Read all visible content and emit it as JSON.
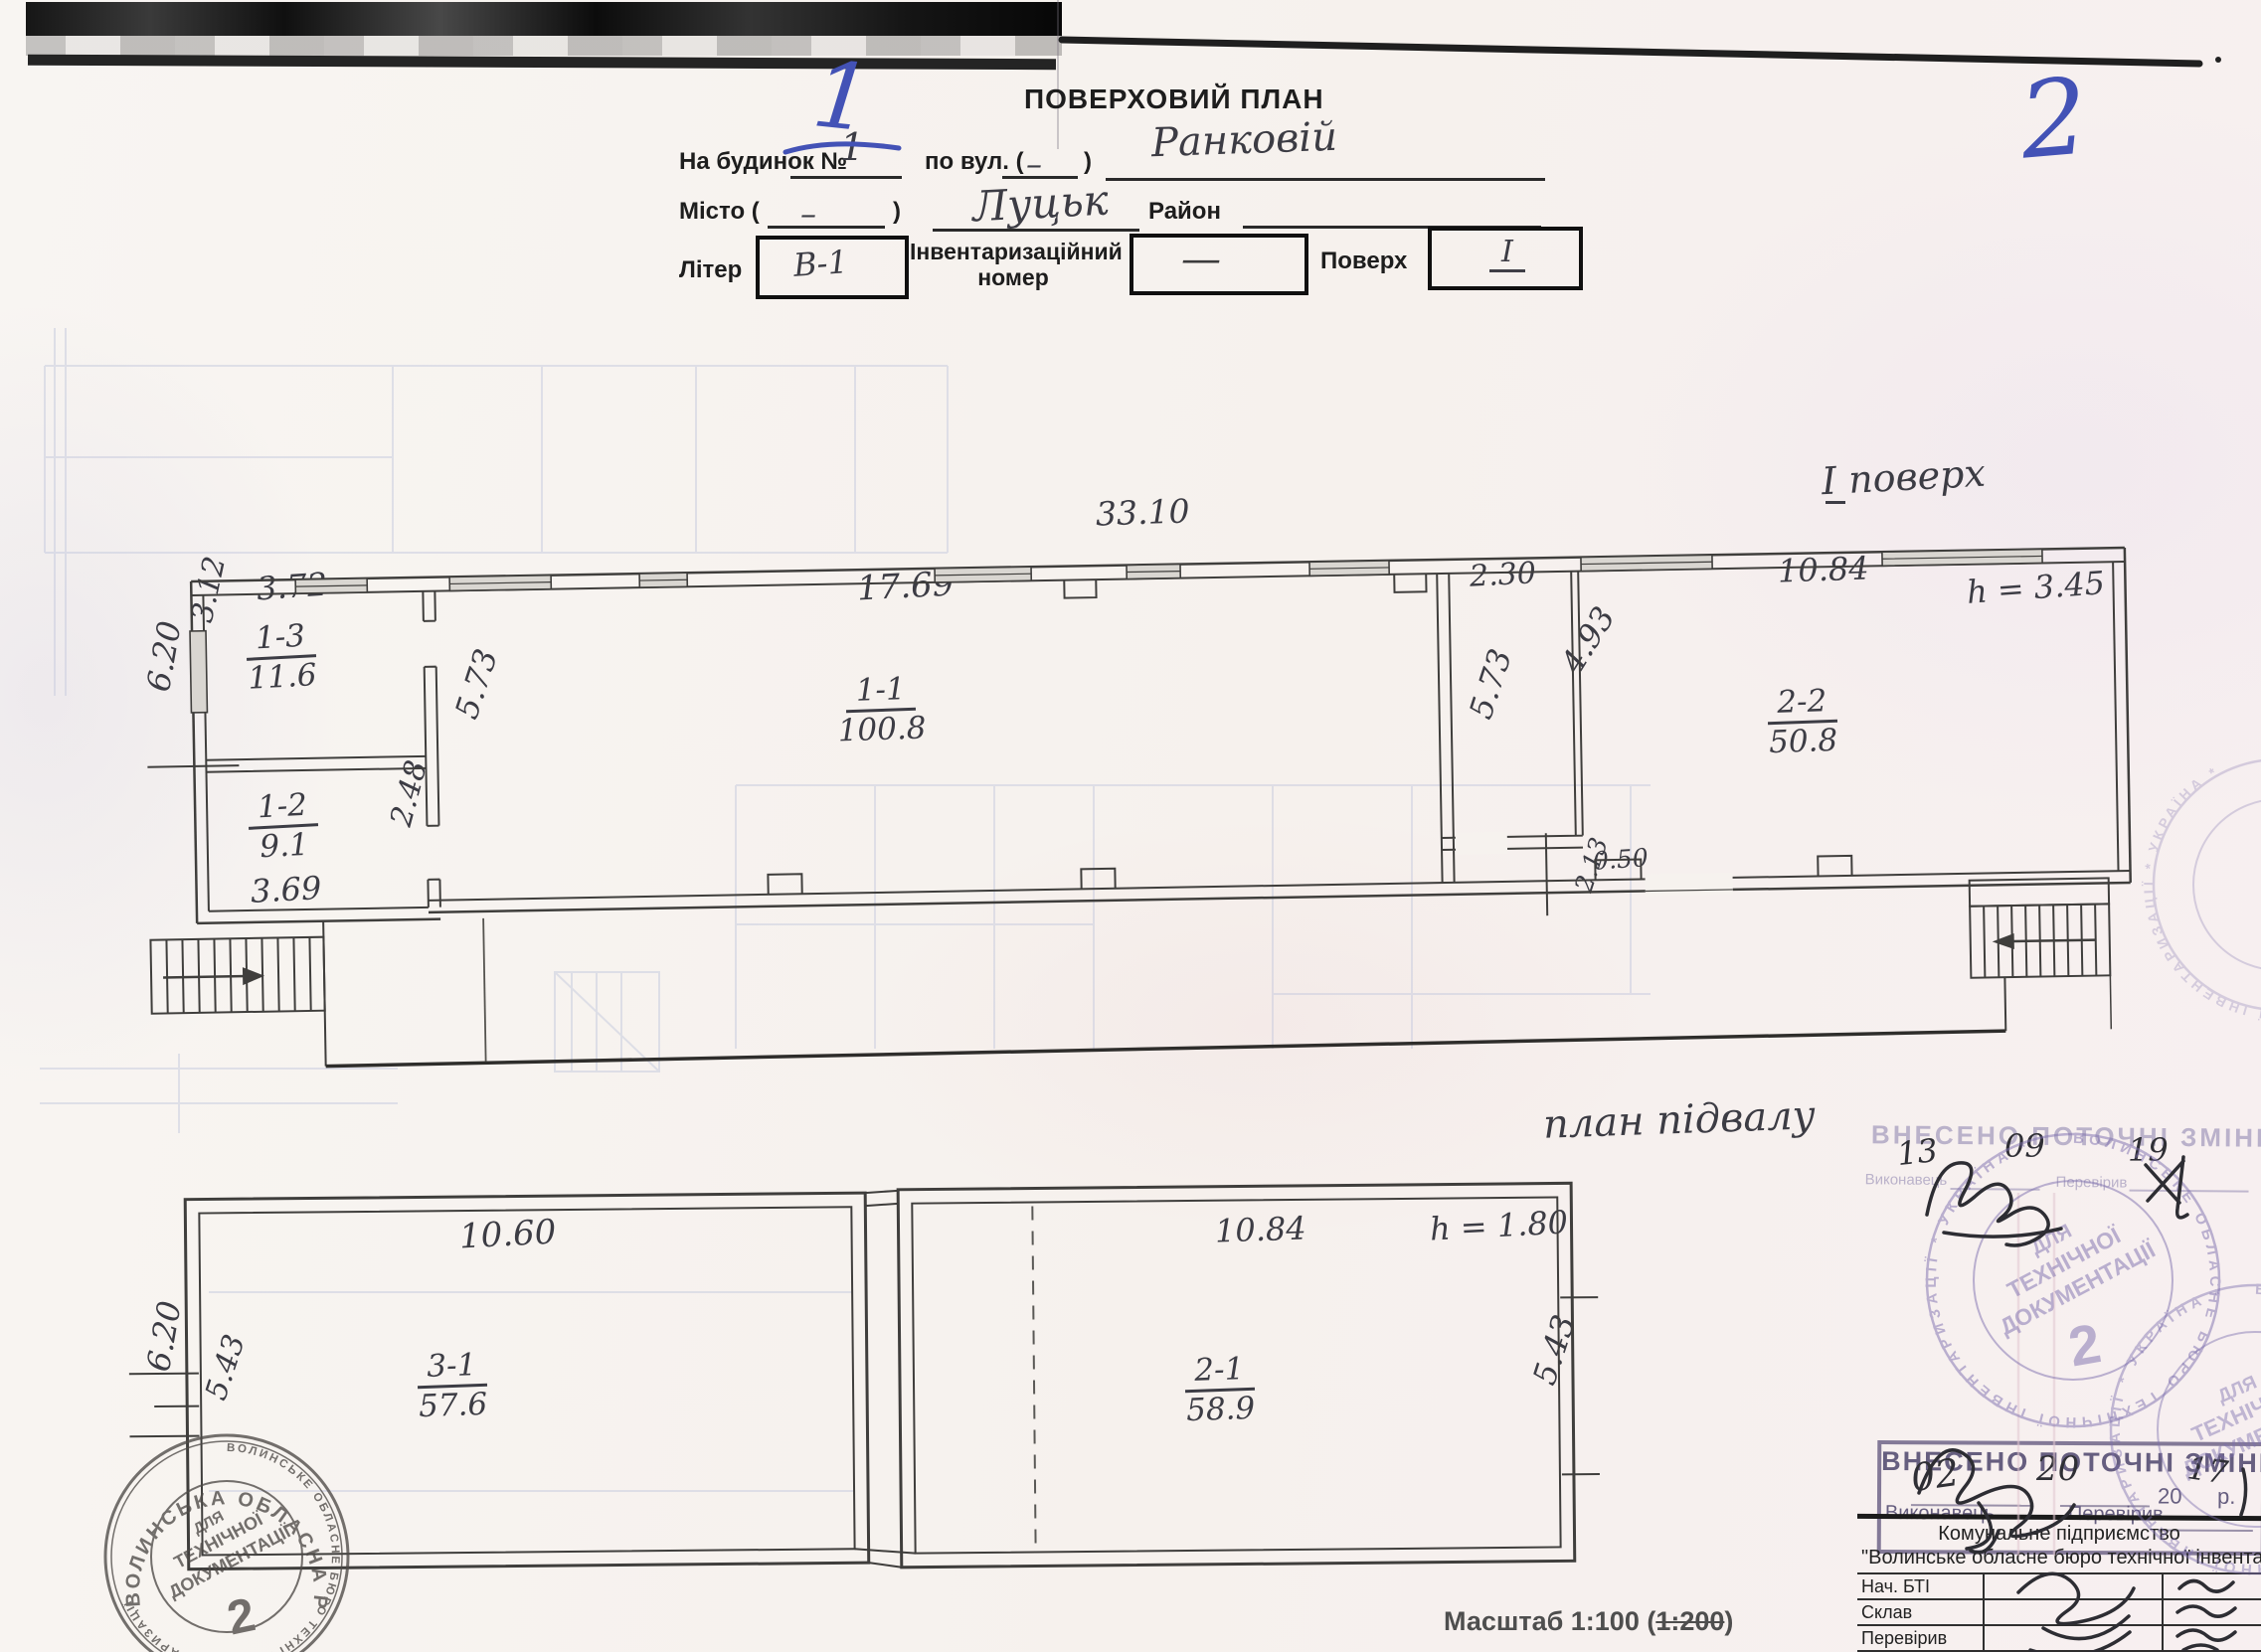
{
  "page": {
    "left_page_number": "1",
    "right_page_number": "2"
  },
  "header": {
    "title": "ПОВЕРХОВИЙ ПЛАН",
    "building_label": "На будинок №",
    "building_number": "1",
    "street_label": "по вул. (",
    "street_dash": "–",
    "street_paren_close": ")",
    "street_name": "Ранковій",
    "city_label": "Місто (",
    "city_dash": "–",
    "city_paren_close": ")",
    "city_name": "Луцьк",
    "district_label": "Район",
    "liter_label": "Літер",
    "liter_value": "В-1",
    "inventory_label_line1": "Інвентаризаційний",
    "inventory_label_line2": "номер",
    "inventory_value": "—",
    "floor_label": "Поверх",
    "floor_value": "І"
  },
  "floor_plan": {
    "title": "І поверх",
    "height_note": "h = 3.45",
    "dim_total_width": "33.10",
    "dim_room_1_1_width": "17.69",
    "dim_corridor_width": "2.30",
    "dim_room_2_2_width": "10.84",
    "dim_room_1_3_width": "3.72",
    "dim_room_1_3_height": "3.12",
    "dim_left_wall": "6.20",
    "dim_room_1_1_left": "5.73",
    "dim_door_1_2": "2.48",
    "dim_room_1_2_width": "3.69",
    "dim_corridor_height": "5.73",
    "dim_corridor_diag": "4.93",
    "dim_pilaster_height": "2.13",
    "dim_pilaster_width": "0.50",
    "rooms": [
      {
        "number": "1-3",
        "area": "11.6"
      },
      {
        "number": "1-2",
        "area": "9.1"
      },
      {
        "number": "1-1",
        "area": "100.8"
      },
      {
        "number": "2-2",
        "area": "50.8"
      }
    ]
  },
  "basement_plan": {
    "title": "план підвалу",
    "height_note": "h = 1.80",
    "dim_left_room_width": "10.60",
    "dim_right_room_width": "10.84",
    "dim_left_wall": "6.20",
    "dim_left_inner": "5.43",
    "dim_right_inner": "5.43",
    "rooms": [
      {
        "number": "3-1",
        "area": "57.6"
      },
      {
        "number": "2-1",
        "area": "58.9"
      }
    ]
  },
  "stamps": {
    "changes_stamp_top": {
      "title": "ВНЕСЕНО ПОТОЧНІ ЗМІНИ",
      "day": "13",
      "month": "09",
      "year": "19",
      "executor_label": "Виконавець",
      "checker_label": "Перевірив"
    },
    "changes_stamp_bottom": {
      "title": "ВНЕСЕНО ПОТОЧНІ ЗМІНИ",
      "day": "02",
      "month": "20",
      "year_prefix": "20",
      "year_written": "17",
      "year_suffix": "р.",
      "executor_label": "Виконавець",
      "checker_label": "Перевірив"
    },
    "round_stamp_violet": {
      "ring_text": "ВОЛИНСЬКЕ ОБЛАСНЕ БЮРО ТЕХНІЧНОЇ ІНВЕНТАРИЗАЦІЇ * УКРАЇНА *",
      "center_line1": "ДЛЯ",
      "center_line2": "ТЕХНІЧНОЇ",
      "center_line3": "ДОКУМЕНТАЦІЇ",
      "center_number": "2"
    },
    "round_stamp_gray": {
      "ring_text": "ВОЛИНСЬКЕ ОБЛАСНЕ БЮРО ТЕХНІЧНОЇ ІНВЕНТАРИЗАЦІЇ",
      "arc_text": "ВОЛИНСЬКА ОБЛАСНА РАДА",
      "center_line1": "ДЛЯ",
      "center_line2": "ТЕХНІЧНОЇ",
      "center_line3": "ДОКУМЕНТАЦІЇ",
      "center_number": "2"
    }
  },
  "org_table": {
    "org_line1": "Комунальне підприємство",
    "org_line2": "\"Волинське обласне бюро технічної інвентариз",
    "rows": [
      {
        "label": "Нач. БТІ"
      },
      {
        "label": "Склав"
      },
      {
        "label": "Перевірив"
      },
      {
        "label": "К"
      }
    ]
  },
  "footer": {
    "scale_prefix": "Масштаб 1:100 (",
    "scale_struck": "1:200",
    "scale_suffix": ")"
  }
}
